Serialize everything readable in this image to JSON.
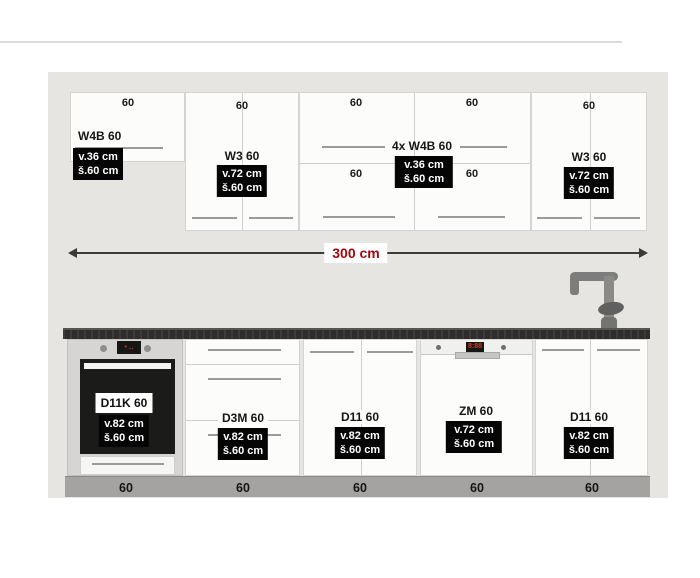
{
  "diagram": {
    "total_width_label": "300 cm",
    "upper_row": {
      "cab1": {
        "width_label": "60",
        "code": "W4B 60",
        "height_dim": "v.36 cm",
        "width_dim": "š.60 cm"
      },
      "cab2": {
        "width_label": "60",
        "code": "W3 60",
        "height_dim": "v.72 cm",
        "width_dim": "š.60 cm"
      },
      "block": {
        "width_label_tl": "60",
        "width_label_tr": "60",
        "width_label_bl": "60",
        "width_label_br": "60",
        "code": "4x W4B 60",
        "height_dim": "v.36 cm",
        "width_dim": "š.60 cm"
      },
      "cab4": {
        "width_label": "60",
        "code": "W3 60",
        "height_dim": "v.72 cm",
        "width_dim": "š.60 cm"
      }
    },
    "lower_row": {
      "cab1": {
        "code": "D11K 60",
        "height_dim": "v.82 cm",
        "width_dim": "š.60 cm",
        "plinth_label": "60"
      },
      "cab2": {
        "code": "D3M 60",
        "height_dim": "v.82 cm",
        "width_dim": "š.60 cm",
        "plinth_label": "60"
      },
      "cab3": {
        "code": "D11 60",
        "height_dim": "v.82 cm",
        "width_dim": "š.60 cm",
        "plinth_label": "60"
      },
      "cab4": {
        "code": "ZM 60",
        "height_dim": "v.72 cm",
        "width_dim": "š.60 cm",
        "plinth_label": "60"
      },
      "cab5": {
        "code": "D11 60",
        "height_dim": "v.82 cm",
        "width_dim": "š.60 cm",
        "plinth_label": "60"
      },
      "dishwasher_display": "8:88"
    },
    "colors": {
      "dimension_text": "#a3070f",
      "label_bg": "#000000",
      "label_text": "#ffffff",
      "wall": "#e6e5e2"
    }
  }
}
